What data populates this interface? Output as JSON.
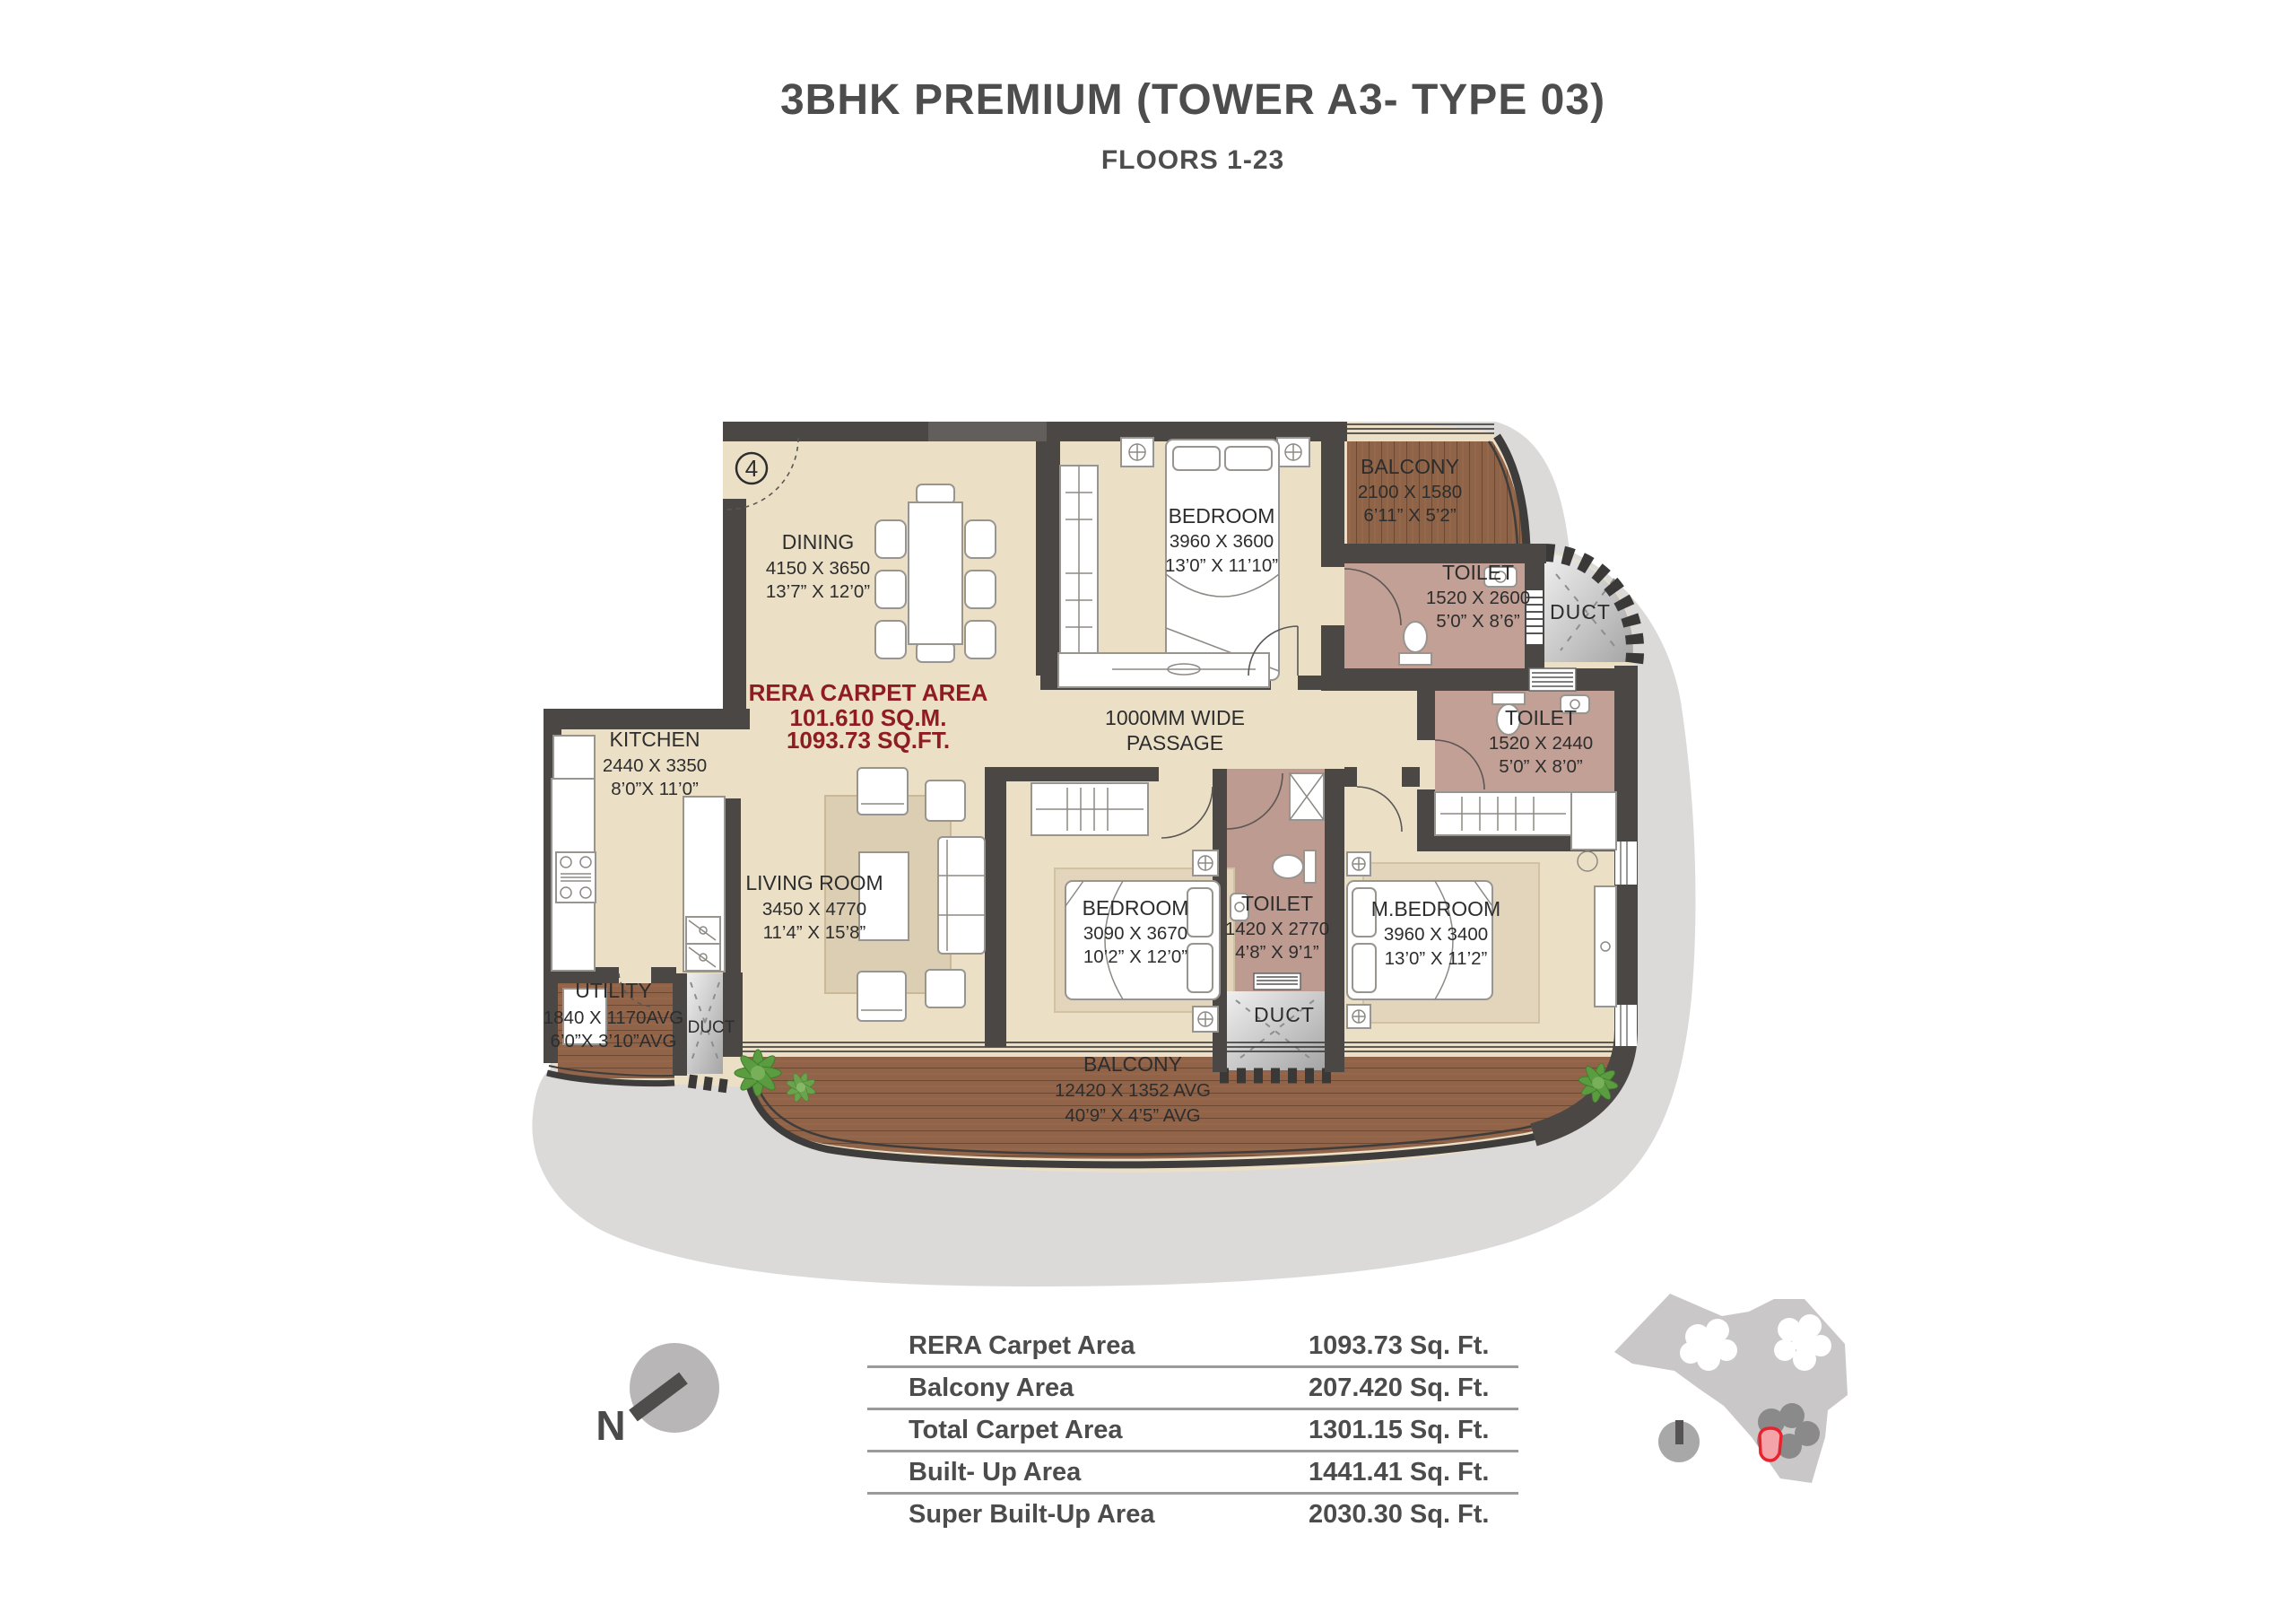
{
  "title": "3BHK PREMIUM (TOWER A3- TYPE 03)",
  "subtitle": "FLOORS 1-23",
  "unit_marker": "4",
  "rera_area_note": {
    "line1": "RERA CARPET AREA",
    "line2": "101.610 SQ.M.",
    "line3": "1093.73 SQ.FT."
  },
  "passage": {
    "line1": "1000MM WIDE",
    "line2": "PASSAGE"
  },
  "compass": {
    "label": "N"
  },
  "rooms": {
    "dining": {
      "name": "DINING",
      "mm": "4150 X 3650",
      "ft": "13’7” X 12’0”"
    },
    "kitchen": {
      "name": "KITCHEN",
      "mm": "2440 X 3350",
      "ft": "8’0”X 11’0”"
    },
    "living": {
      "name": "LIVING ROOM",
      "mm": "3450 X 4770",
      "ft": "11’4” X 15’8”"
    },
    "bedroom_top": {
      "name": "BEDROOM",
      "mm": "3960 X 3600",
      "ft": "13’0” X 11’10”"
    },
    "balcony_top": {
      "name": "BALCONY",
      "mm": "2100 X 1580",
      "ft": "6’11” X 5’2”"
    },
    "toilet_top": {
      "name": "TOILET",
      "mm": "1520 X 2600",
      "ft": "5’0” X 8’6”"
    },
    "toilet_right": {
      "name": "TOILET",
      "mm": "1520 X 2440",
      "ft": "5’0” X 8’0”"
    },
    "bedroom_mid": {
      "name": "BEDROOM",
      "mm": "3090 X 3670",
      "ft": "10’2” X 12’0”"
    },
    "toilet_mid": {
      "name": "TOILET",
      "mm": "1420 X 2770",
      "ft": "4’8” X 9’1”"
    },
    "master_bedroom": {
      "name": "M.BEDROOM",
      "mm": "3960 X 3400",
      "ft": "13’0” X 11’2”"
    },
    "utility": {
      "name": "UTILITY",
      "mm": "1840 X 1170AVG",
      "ft": "6’0”X 3’10”AVG"
    },
    "balcony_bottom": {
      "name": "BALCONY",
      "mm": "12420 X 1352 AVG",
      "ft": "40’9” X 4’5” AVG"
    },
    "duct_top": {
      "name": "DUCT"
    },
    "duct_mid": {
      "name": "DUCT"
    },
    "duct_left": {
      "name": "DUCT"
    }
  },
  "area_table": {
    "rows": [
      {
        "label": "RERA Carpet Area",
        "value": "1093.73 Sq. Ft."
      },
      {
        "label": "Balcony Area",
        "value": "207.420 Sq. Ft."
      },
      {
        "label": "Total Carpet Area",
        "value": "1301.15 Sq. Ft."
      },
      {
        "label": "Built- Up Area",
        "value": "1441.41 Sq. Ft."
      },
      {
        "label": "Super Built-Up Area",
        "value": "2030.30 Sq. Ft."
      }
    ]
  },
  "colors": {
    "accent_red": "#8E1C21",
    "wall": "#4A4745",
    "wood": "#8F6347",
    "toilet_floor": "#C2A095",
    "floor_beige": "#EBDFC6",
    "shadow_gray": "#DCD9D9",
    "keyplan_highlight": "#E8232E"
  }
}
